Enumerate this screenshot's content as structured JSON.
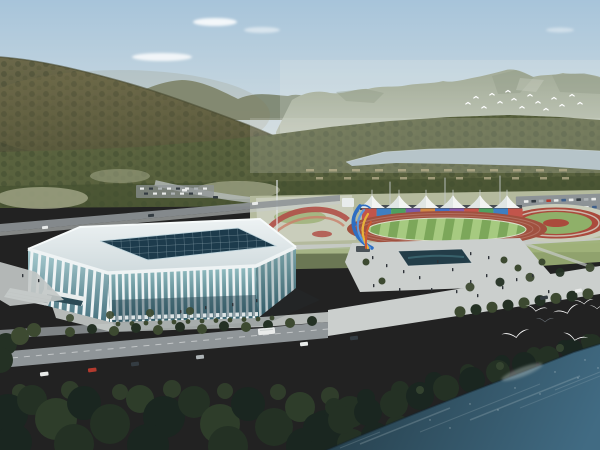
{
  "scene": {
    "description": "Aerial architectural rendering of a riverside sports complex: a white lattice-facade stadium with dark glass skylight roof, an athletics track with striped green infield, a rainbow panel wall below six white canopy tents, a twisting blue-and-yellow ribbon sculpture on a plaza, circular red-and-green parterre gardens, tree-lined roads with cars and a bus, forested mountains and a pale river in the distance, white egrets flying over dark teal water in the foreground",
    "elements": {
      "stadium": "white ribbed aquatic stadium with dark glass grid skylight",
      "running_track": "red athletics track with mowed-stripe green infield",
      "canopy_tents": "row of white peaked grandstand canopies",
      "rainbow_wall": "multicolored panel wall behind the back straight",
      "sculpture": "twisting blue, yellow and orange ribbon sculpture",
      "circular_garden": "red ring and green center parterre garden",
      "flower_garden": "swirling red flower beds beside a flagpole",
      "distant_river": "pale gray-blue river beyond the tree belt",
      "foreground_water": "dark teal river along the lower right shore",
      "foreground_birds": "white egrets gliding above shoreline trees",
      "distant_birds": "small white flock against the mountain face",
      "mountains": "hazy forested mountain ranges",
      "left_hill": "dense olive-brown forested hillside"
    },
    "counts": {
      "canopy_tents": 6,
      "foreground_birds": 7,
      "distant_birds": 15
    }
  },
  "rainbow": [
    "#c2554b",
    "#3f7fc2",
    "#4fa05f",
    "#7b5aa8",
    "#d08a46",
    "#466fc0",
    "#8a5aa8",
    "#c2554b",
    "#4fa05f",
    "#3f7fc2",
    "#c2554b"
  ],
  "colors": {
    "skyTop": "#a7c4da",
    "skyHaze": "#e0e6e4",
    "cloud": "#ffffff",
    "mountain": "#8f9981",
    "mountainBase": "#bcc3b2",
    "mountainShade": "#79846c",
    "ridge": "#7e8872",
    "hillTop": "#6b684a",
    "hillBase": "#484c33",
    "forest": "#59623e",
    "forestDeep": "#434e2e",
    "riverFar": "#b6c4c9",
    "fieldLight": "#a8ac8e",
    "parkGround": "#b4ba9d",
    "lawn": "#9cb076",
    "trackRed": "#a0513f",
    "infieldA": "#a6ca80",
    "infieldB": "#7ca75a",
    "tent": "#f2f4f2",
    "tentShade": "#d9dfde",
    "roadGray": "#8f9598",
    "roadLight": "#c7cbc9",
    "plaza": "#cbcfcd",
    "parking": "#8d9396",
    "roofLight": "#edf2f3",
    "roofShade": "#cfdadd",
    "skylight": "#1d3b4c",
    "rib": "#eef3f4",
    "glassTop": "#93bec2",
    "glassBot": "#35616e",
    "glassDark": "#2b4a55",
    "gardenRed": "#aa4a3c",
    "gardenGreen": "#8fb069",
    "gardenBase": "#c9cdbb",
    "flowerRed": "#b05048",
    "pond": "#233d48",
    "sculptBlue": "#2e6ec2",
    "sculptBlueL": "#5b97dd",
    "sculptYellow": "#e7b23a",
    "sculptOrange": "#cf5a33",
    "treeMid": "#3d4a31",
    "treeDark": "#243124",
    "treeFg": "#1a2620",
    "waterNear": "#27414e",
    "waterFar": "#416b83",
    "waterStreak": "#b9c9cd",
    "gull": "#ffffff",
    "gullGray": "#6b7278",
    "people": "#2e3338",
    "struct": "#b9b08e",
    "vehWhite": "#e9ebea",
    "vehRed": "#b33a2e",
    "vehDark": "#343c42",
    "vehSilver": "#aeb4b6",
    "vehBlue": "#3e5f8a"
  }
}
